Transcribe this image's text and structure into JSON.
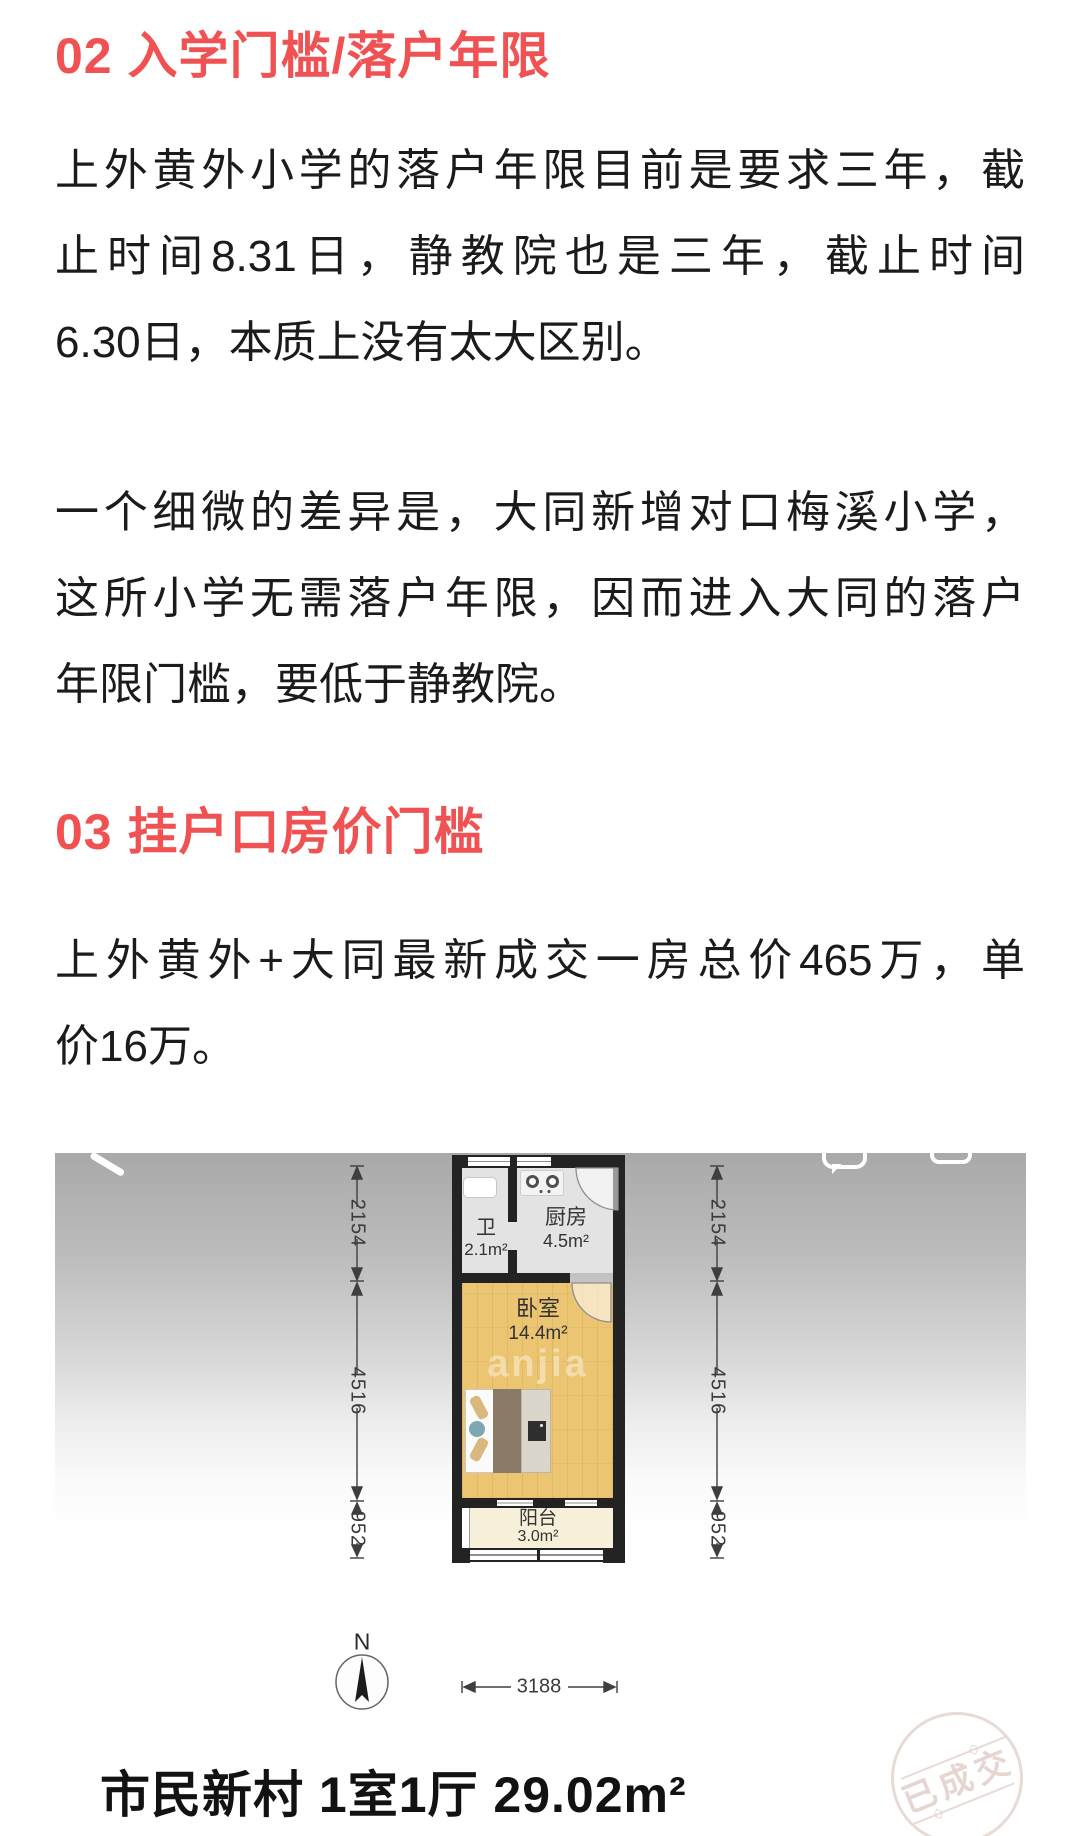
{
  "article": {
    "h2": "02 入学门槛/落户年限",
    "p1": [
      "上外黄外小学的落户年限目前是要求三年，截",
      "止时间8.31日，静教院也是三年，截止时间",
      "6.30日，本质上没有太大区别。"
    ],
    "p2": [
      "一个细微的差异是，大同新增对口梅溪小学，",
      "这所小学无需落户年限，因而进入大同的落户",
      "年限门槛，要低于静教院。"
    ],
    "h3": "03 挂户口房价门槛",
    "p3": [
      "上外黄外+大同最新成交一房总价465万，单",
      "价16万。"
    ]
  },
  "floorplan": {
    "rooms": {
      "bathroom": {
        "label": "卫",
        "area": "2.1m²"
      },
      "kitchen": {
        "label": "厨房",
        "area": "4.5m²"
      },
      "bedroom": {
        "label": "卧室",
        "area": "14.4m²"
      },
      "balcony": {
        "label": "阳台",
        "area": "3.0m²"
      }
    },
    "dims": {
      "v_top": "2154",
      "v_mid": "4516",
      "v_bottom": "952",
      "h_width": "3188"
    },
    "compass": "N",
    "watermark": "anjia",
    "stamp": "已成交",
    "caption": "市民新村 1室1厅 29.02m²"
  },
  "colors": {
    "accent_red": "#f05152",
    "body_text": "#1b1b1b"
  }
}
